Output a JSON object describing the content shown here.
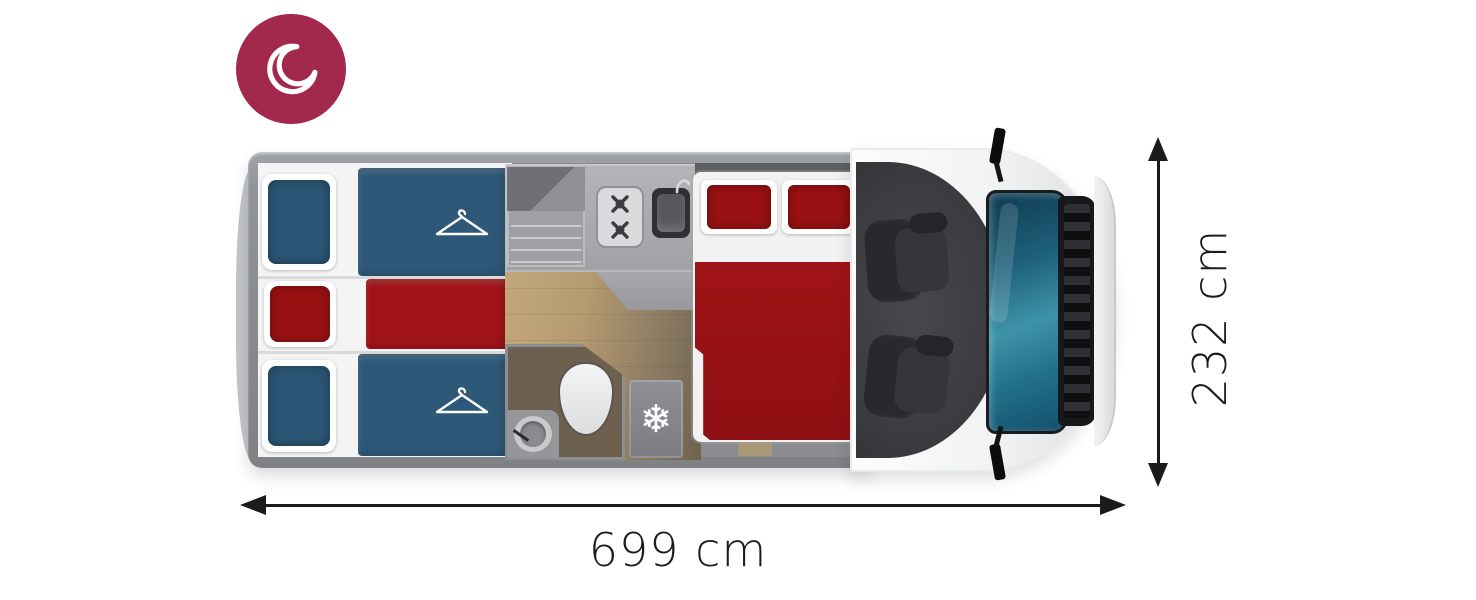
{
  "diagram": {
    "type": "motorhome-floorplan-top-view",
    "mode": "night-layout"
  },
  "badge": {
    "icon": "moon-icon"
  },
  "dimensions": {
    "length": "699 cm",
    "width": "232 cm"
  },
  "icons": {
    "moon-icon": "crescent-moon",
    "hanger-icon": "clothes-hanger",
    "snowflake-icon": "❄"
  },
  "floorplan": {
    "zones": [
      {
        "name": "rear-bedroom",
        "features": [
          "single-bed-blue-top",
          "single-bed-red-middle",
          "single-bed-blue-bottom",
          "hanger-icon-top",
          "hanger-icon-bottom"
        ]
      },
      {
        "name": "kitchen",
        "features": [
          "cabinet-with-shelves",
          "two-burner-stove",
          "kitchen-sink"
        ]
      },
      {
        "name": "bathroom",
        "features": [
          "toilet",
          "washbasin"
        ]
      },
      {
        "name": "galley",
        "features": [
          "refrigerator-snowflake"
        ]
      },
      {
        "name": "mid-bedroom",
        "features": [
          "double-bed-red"
        ]
      },
      {
        "name": "cab",
        "features": [
          "swivel-seat-left",
          "swivel-seat-right",
          "windshield",
          "side-mirror-top",
          "side-mirror-bottom"
        ]
      }
    ]
  },
  "colors": {
    "badge": "#A2294B",
    "bed-blue": "#2E5878",
    "pillow-blue": "#2B5574",
    "bed-red": "#A01316",
    "pillow-red": "#991113",
    "duvet-red-dark": "#8E1013",
    "wall": "#909397",
    "wall-dark": "#5C5E61",
    "interior": "#8A8C90",
    "cabinet": "#9EA0A4",
    "wood-1": "#C4A77C",
    "wood-2": "#6E624F",
    "bath": "#6E604F",
    "fridge": "#8E9094",
    "cab": "#3A3C40",
    "seat": "#27292C",
    "seat-2": "#34363A",
    "glass-a": "#0F3B52",
    "glass-b": "#3E93A8",
    "line": "#1B1B1B"
  }
}
